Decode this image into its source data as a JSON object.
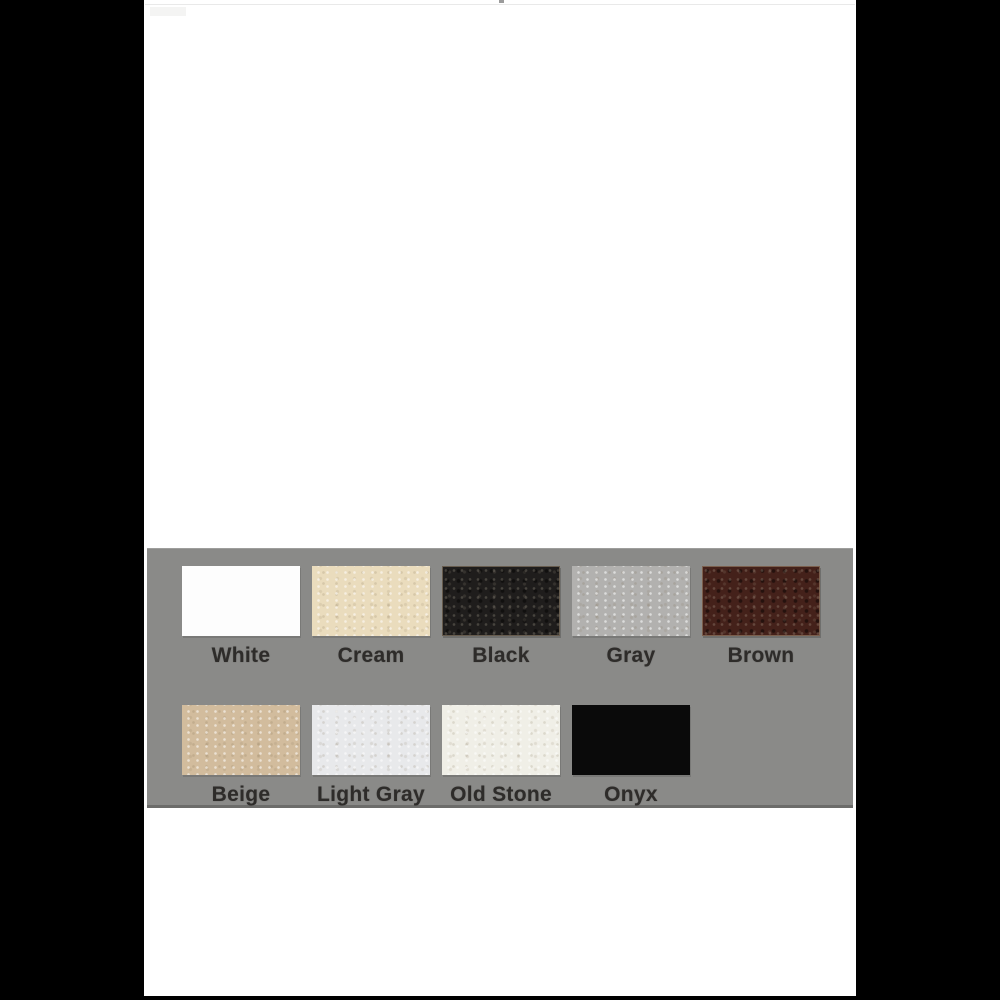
{
  "page": {
    "background": "#ffffff",
    "pillarbox_color": "#000000"
  },
  "palette_panel": {
    "background": "#8a8a88",
    "label_color": "#2e2c2a",
    "rows": [
      {
        "swatches": [
          {
            "name": "White",
            "color": "#fdfdfd",
            "texture": "none"
          },
          {
            "name": "Cream",
            "color": "#eadcbd",
            "texture": "speckle-light"
          },
          {
            "name": "Black",
            "color": "#1f1d1c",
            "texture": "speckle-dark"
          },
          {
            "name": "Gray",
            "color": "#b2b1af",
            "texture": "speckle-light"
          },
          {
            "name": "Brown",
            "color": "#44211a",
            "texture": "speckle-dark"
          }
        ]
      },
      {
        "swatches": [
          {
            "name": "Beige",
            "color": "#d2bc9d",
            "texture": "speckle-light"
          },
          {
            "name": "Light Gray",
            "color": "#e8e9eb",
            "texture": "speckle-light"
          },
          {
            "name": "Old Stone",
            "color": "#f0efe7",
            "texture": "speckle-light"
          },
          {
            "name": "Onyx",
            "color": "#0a0a0a",
            "texture": "none"
          }
        ]
      }
    ]
  }
}
